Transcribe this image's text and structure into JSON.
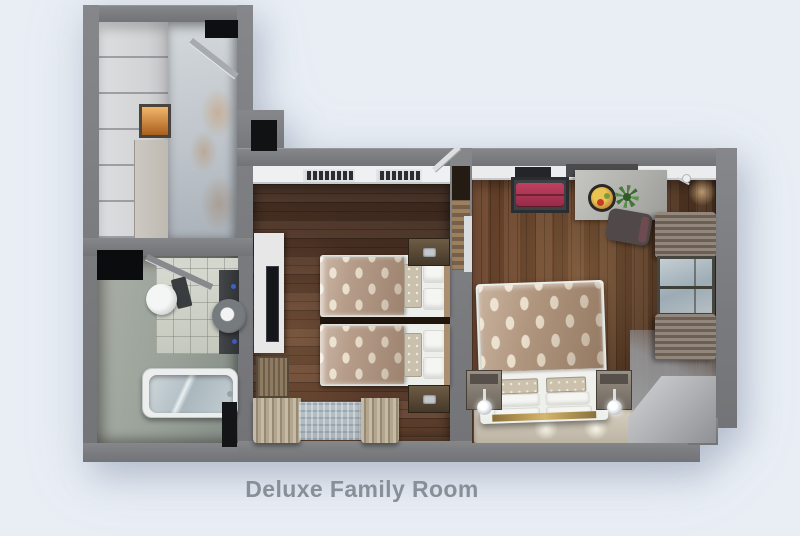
{
  "title": "Deluxe Family Room",
  "palette": {
    "background": "#e9eef5",
    "wall": "#7d7e81",
    "wood_floor": "#5a3c2a",
    "bath_floor": "#9aa29a",
    "duvet_base": "#b59c87",
    "duvet_dot": "#eadfcd",
    "suitcase_accent": "#aa2f4f",
    "lit_niche_accent": "#d98b3c",
    "title_text": "#8a8e96"
  },
  "rooms": {
    "entry_hall": {
      "items": [
        "wardrobe",
        "lit-niche",
        "entrance-door",
        "tile-floor"
      ]
    },
    "bathroom": {
      "items": [
        "toilet",
        "vanity-sink",
        "bathtub",
        "door"
      ]
    },
    "twin_bedroom": {
      "items": [
        "twin-bed-a",
        "twin-bed-b",
        "nightstand-a",
        "nightstand-b",
        "tv-console",
        "tv",
        "bench",
        "window-curtains",
        "ceiling-vents",
        "connecting-door"
      ]
    },
    "double_bedroom": {
      "items": [
        "double-bed",
        "nightstand-left",
        "nightstand-right",
        "bedside-lamps",
        "desk",
        "chair",
        "fruit-bowl",
        "plant",
        "suitcase-on-rack",
        "window-with-curtains",
        "wall-sconce",
        "carpet-runner"
      ]
    }
  }
}
